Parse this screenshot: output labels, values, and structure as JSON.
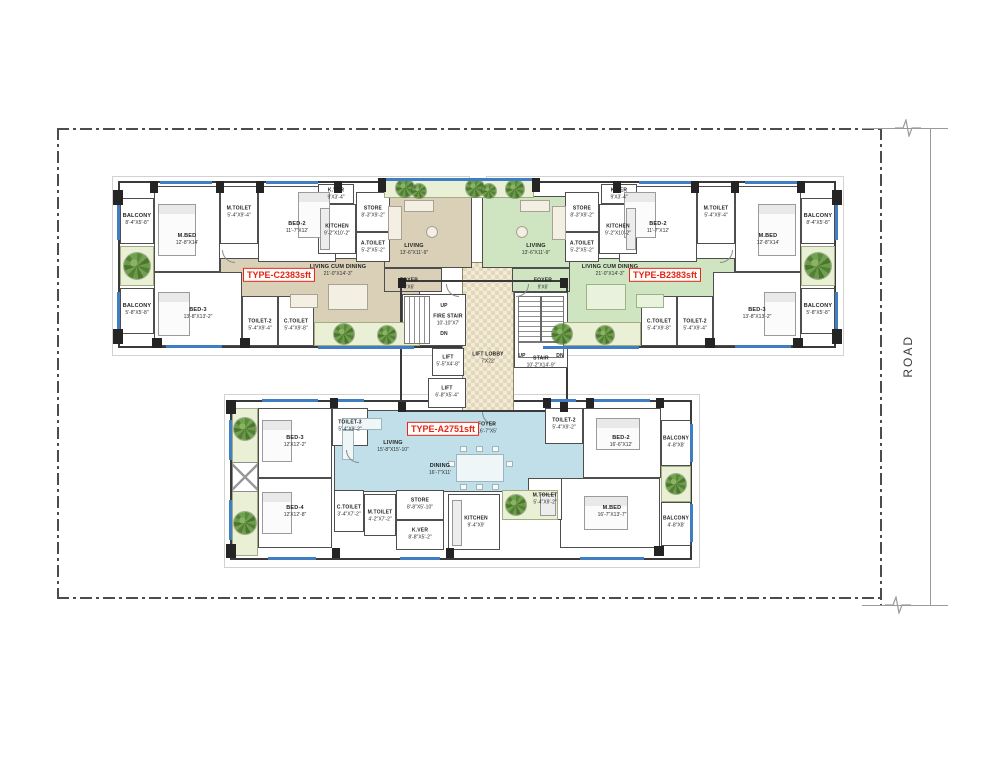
{
  "site": {
    "road_label": "ROAD"
  },
  "colors": {
    "type_c_fill": "#d9d0b7",
    "type_b_fill": "#cfe5c1",
    "type_a_fill": "#c0dfe9",
    "planter_fill": "#e9f0d6",
    "window_blue": "#3f7ec2",
    "wall_dark": "#242424",
    "badge_red": "#e4241c"
  },
  "core": {
    "fire_stair": {
      "name": "FIRE STAIR",
      "dim": "10'-10\"X7'"
    },
    "stair": {
      "name": "STAIR",
      "dim": "10'-2\"X14'-9\""
    },
    "lift1": {
      "name": "LIFT",
      "dim": "5'-5\"X4'-8\""
    },
    "lift2": {
      "name": "LIFT",
      "dim": "6'-8\"X5'-4\""
    },
    "lift_lobby": {
      "name": "LIFT LOBBY",
      "dim": "7'X22'"
    },
    "up_label": "UP",
    "dn_label": "DN"
  },
  "units": {
    "type_c": {
      "badge": {
        "type": "TYPE-C",
        "area": "2383sft"
      },
      "rooms": {
        "balcony1": {
          "name": "BALCONY",
          "dim": "8'-4\"X5'-8\""
        },
        "balcony2": {
          "name": "BALCONY",
          "dim": "5'-8\"X5'-8\""
        },
        "m_bed": {
          "name": "M.BED",
          "dim": "12'-8\"X14'"
        },
        "m_toilet": {
          "name": "M.TOILET",
          "dim": "5'-4\"X9'-4\""
        },
        "bed2": {
          "name": "BED-2",
          "dim": "11'-7\"X12'"
        },
        "bed3": {
          "name": "BED-3",
          "dim": "13'-8\"X13'-2\""
        },
        "toilet2": {
          "name": "TOILET-2",
          "dim": "5'-4\"X9'-4\""
        },
        "c_toilet": {
          "name": "C.TOILET",
          "dim": "5'-4\"X9'-8\""
        },
        "kver": {
          "name": "K.VER",
          "dim": "9'X3'-4\""
        },
        "store": {
          "name": "STORE",
          "dim": "8'-3\"X9'-2\""
        },
        "kitchen": {
          "name": "KITCHEN",
          "dim": "9'-2\"X10'-2\""
        },
        "a_toilet": {
          "name": "A.TOILET",
          "dim": "5'-2\"X5'-2\""
        },
        "living_dining": {
          "name": "LIVING CUM DINING",
          "dim": "21'-0\"X14'-3\""
        },
        "living": {
          "name": "LIVING",
          "dim": "13'-6\"X11'-9\""
        },
        "foyer": {
          "name": "FOYER",
          "dim": "9'X6'"
        }
      }
    },
    "type_b": {
      "badge": {
        "type": "TYPE-B",
        "area": "2383sft"
      },
      "rooms": {
        "balcony1": {
          "name": "BALCONY",
          "dim": "8'-4\"X5'-8\""
        },
        "balcony2": {
          "name": "BALCONY",
          "dim": "5'-8\"X5'-8\""
        },
        "m_bed": {
          "name": "M.BED",
          "dim": "12'-8\"X14'"
        },
        "m_toilet": {
          "name": "M.TOILET",
          "dim": "5'-4\"X9'-4\""
        },
        "bed2": {
          "name": "BED-2",
          "dim": "11'-7\"X12'"
        },
        "bed3": {
          "name": "BED-3",
          "dim": "13'-8\"X13'-2\""
        },
        "toilet2": {
          "name": "TOILET-2",
          "dim": "5'-4\"X9'-4\""
        },
        "c_toilet": {
          "name": "C.TOILET",
          "dim": "5'-4\"X9'-8\""
        },
        "kver": {
          "name": "K.VER",
          "dim": "9'X3'-4\""
        },
        "store": {
          "name": "STORE",
          "dim": "8'-3\"X9'-2\""
        },
        "kitchen": {
          "name": "KITCHEN",
          "dim": "9'-2\"X10'-2\""
        },
        "a_toilet": {
          "name": "A.TOILET",
          "dim": "5'-2\"X5'-2\""
        },
        "living_dining": {
          "name": "LIVING CUM DINING",
          "dim": "21'-0\"X14'-3\""
        },
        "living": {
          "name": "LIVING",
          "dim": "13'-6\"X11'-9\""
        },
        "foyer": {
          "name": "FOYER",
          "dim": "9'X6'"
        }
      }
    },
    "type_a": {
      "badge": {
        "type": "TYPE-A",
        "area": "2751sft"
      },
      "rooms": {
        "living": {
          "name": "LIVING",
          "dim": "15'-8\"X15'-10\""
        },
        "dining": {
          "name": "DINING",
          "dim": "16'-7\"X11'"
        },
        "foyer": {
          "name": "FOYER",
          "dim": "16'-7\"X5'"
        },
        "bed3": {
          "name": "BED-3",
          "dim": "12'X12'-2\""
        },
        "bed4": {
          "name": "BED-4",
          "dim": "12'X12'-8\""
        },
        "toilet3": {
          "name": "TOILET-3",
          "dim": "5'-4\"X9'-2\""
        },
        "toilet2": {
          "name": "TOILET-2",
          "dim": "5'-4\"X9'-2\""
        },
        "bed2": {
          "name": "BED-2",
          "dim": "16'-6\"X12'"
        },
        "m_bed": {
          "name": "M.BED",
          "dim": "16'-7\"X13'-7\""
        },
        "m_toilet_r": {
          "name": "M.TOILET",
          "dim": "5'-4\"X9'-2\""
        },
        "c_toilet": {
          "name": "C.TOILET",
          "dim": "3'-4\"X7'-2\""
        },
        "m_toilet_b": {
          "name": "M.TOILET",
          "dim": "4'-2\"X7'-2\""
        },
        "store": {
          "name": "STORE",
          "dim": "8'-8\"X5'-10\""
        },
        "kver": {
          "name": "K.VER",
          "dim": "8'-8\"X5'-2\""
        },
        "kitchen": {
          "name": "KITCHEN",
          "dim": "9'-4\"X9'"
        },
        "balcony1": {
          "name": "BALCONY",
          "dim": "4'-8\"X8'"
        },
        "balcony2": {
          "name": "BALCONY",
          "dim": "4'-8\"X8'"
        }
      }
    }
  }
}
